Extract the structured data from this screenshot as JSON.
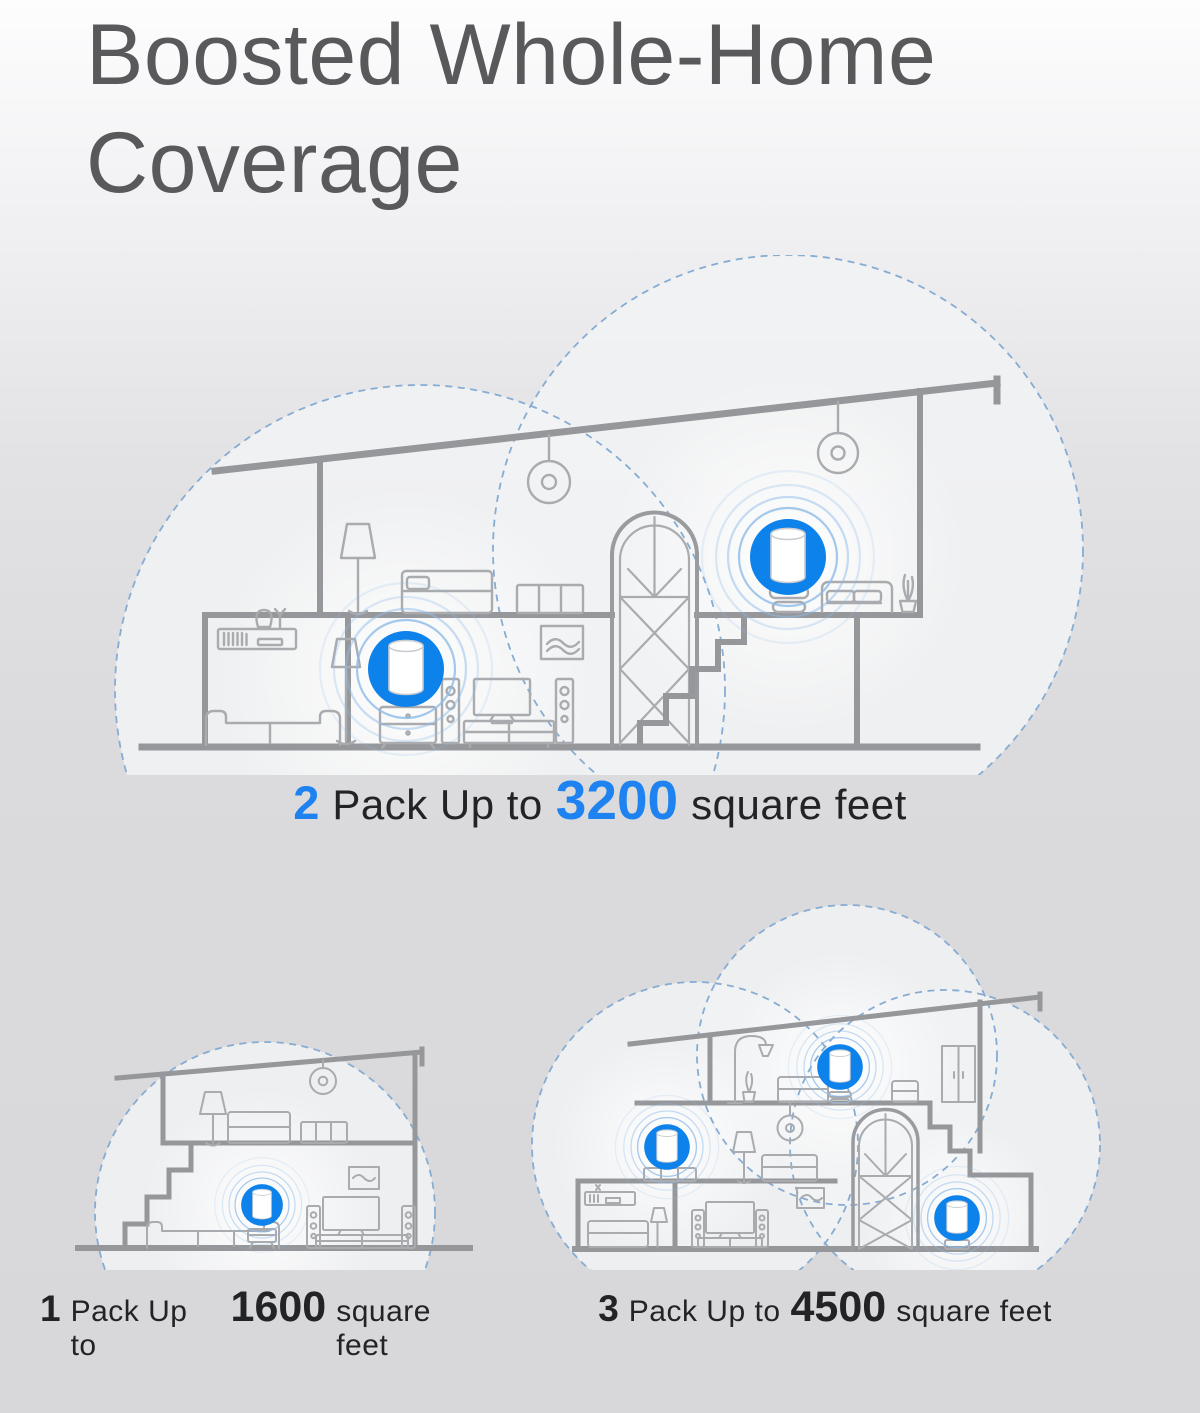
{
  "title": {
    "text": "Boosted Whole-Home Coverage"
  },
  "captions": {
    "two_pack": {
      "count": "2",
      "label": "Pack Up to",
      "area": "3200",
      "unit": "square feet"
    },
    "one_pack": {
      "count": "1",
      "label": "Pack Up to",
      "area": "1600",
      "unit": "square feet"
    },
    "three_pack": {
      "count": "3",
      "label": "Pack Up to",
      "area": "4500",
      "unit": "square feet"
    }
  },
  "colors": {
    "accent_blue": "#1e83f1",
    "router_disc_blue": "#0d82ea",
    "ripple_blue": "#8fbce9",
    "coverage_dash_blue": "#87acd3",
    "title_gray": "#59595c",
    "text_dark": "#222326",
    "house_line_gray": "#96979a"
  },
  "icons": {
    "router": "router-icon (white cylinder on blue disc)",
    "ripples": "wifi-ripple-icon (concentric circles)",
    "coverage": "coverage-area-icon (dashed circle cloud)"
  }
}
